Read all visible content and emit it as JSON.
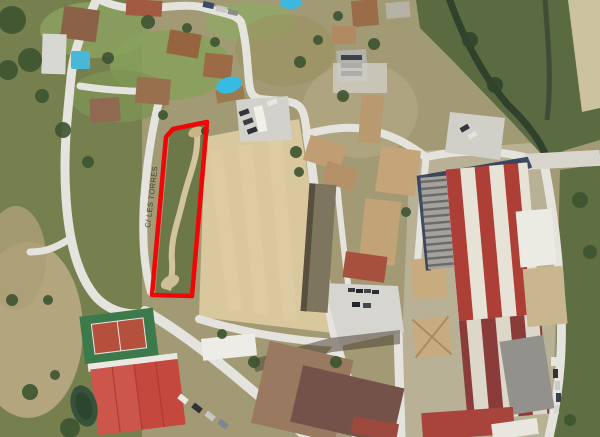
{
  "map": {
    "street_label": "C/ LES TORRES",
    "highlight": {
      "points": "207,122 173,129 166,137 152,295 192,296",
      "color": "#ef0606",
      "stroke_width": "4.5"
    }
  }
}
